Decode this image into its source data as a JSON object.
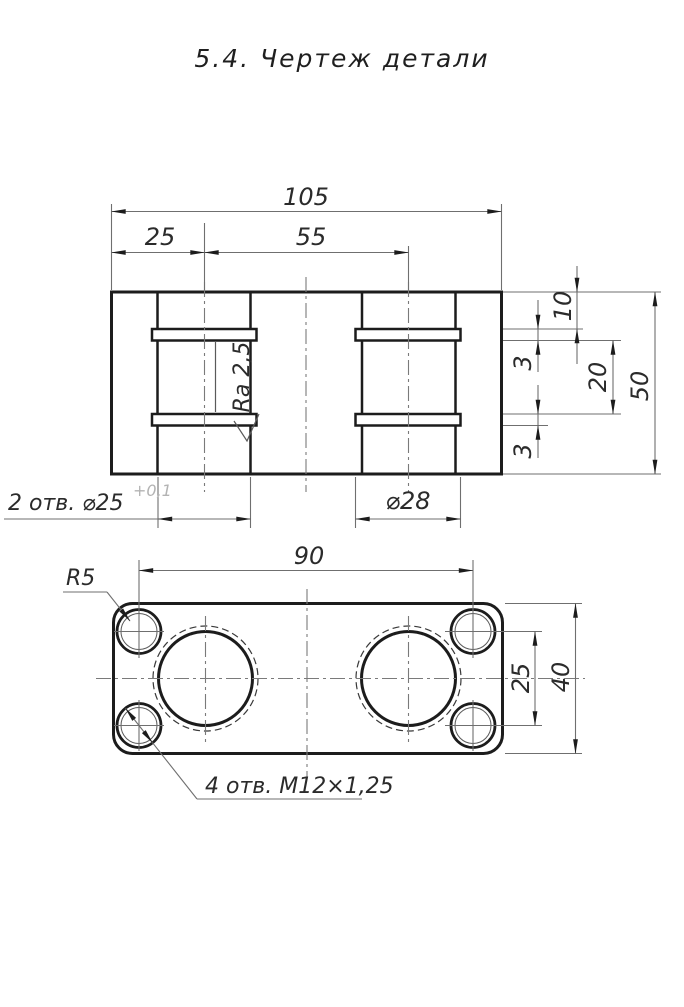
{
  "title": "5.4.  Чертеж детали",
  "section_view": {
    "dim_overall_width": "105",
    "dim_edge_to_hole": "25",
    "dim_hole_spacing": "55",
    "dim_top_to_groove": "10",
    "dim_groove_width_top": "3",
    "dim_groove_spacing": "20",
    "dim_overall_height": "50",
    "dim_groove_width_bottom": "3",
    "note_bore_holes": "2 отв. ⌀25",
    "note_bore_tolerance": "+0,1",
    "dim_groove_diameter": "⌀28",
    "roughness": "Ra 2,5"
  },
  "plan_view": {
    "dim_bolt_span_horizontal": "90",
    "dim_bolt_span_vertical": "25",
    "dim_height": "40",
    "corner_radius": "R5",
    "note_threaded_holes": "4 отв. М12×1,25"
  },
  "colors": {
    "outline": "#1c1c1c",
    "thin_line": "#6f6f6f",
    "hatch": "#9b9b9b",
    "text": "#2b2b2b",
    "tolerance_text": "#b3b3b3",
    "background": "#ffffff"
  }
}
